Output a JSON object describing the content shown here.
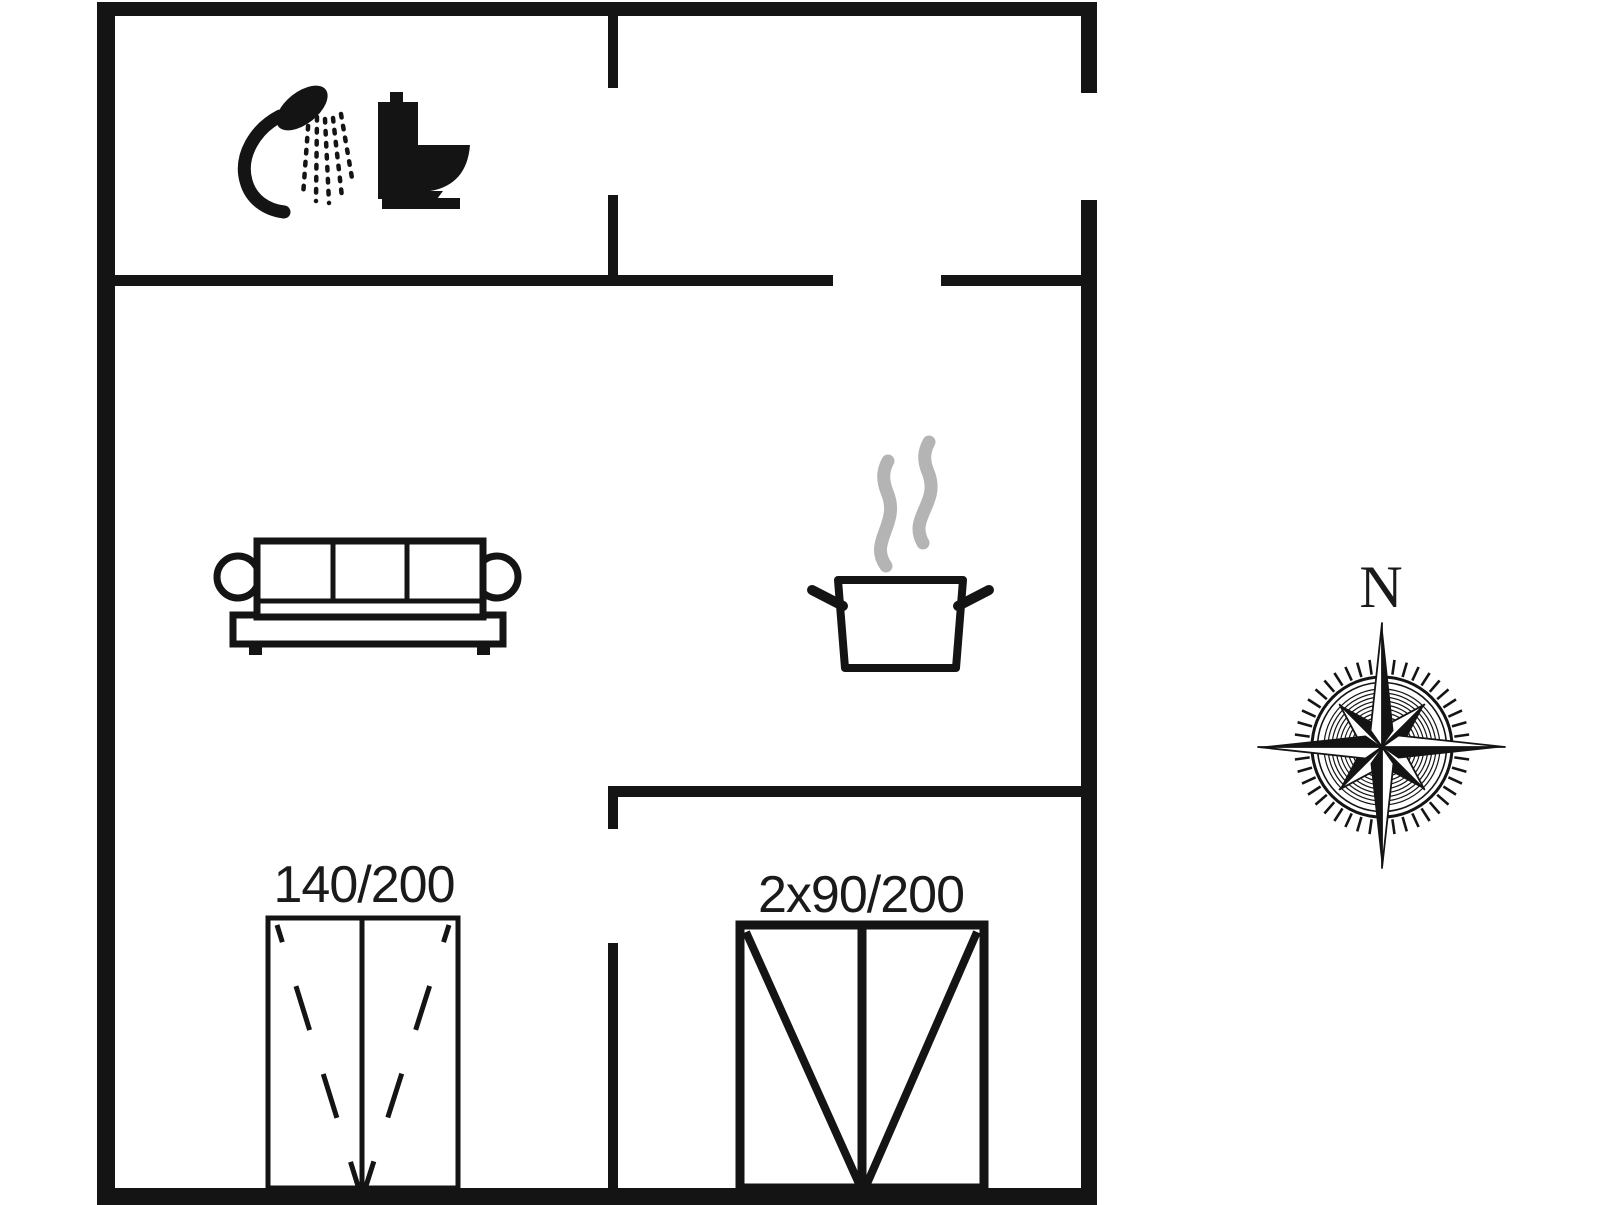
{
  "canvas": {
    "width": 1606,
    "height": 1205,
    "background": "#ffffff"
  },
  "colors": {
    "ink": "#141414",
    "steam": "#b4b4b4",
    "text": "#1a1a1a"
  },
  "labels": {
    "bed_double": "140/200",
    "bed_twin": "2x90/200",
    "compass_north": "N"
  },
  "icons": [
    "shower-icon",
    "toilet-icon",
    "sofa-icon",
    "cooking-pot-icon",
    "steam-icon",
    "compass-rose"
  ]
}
